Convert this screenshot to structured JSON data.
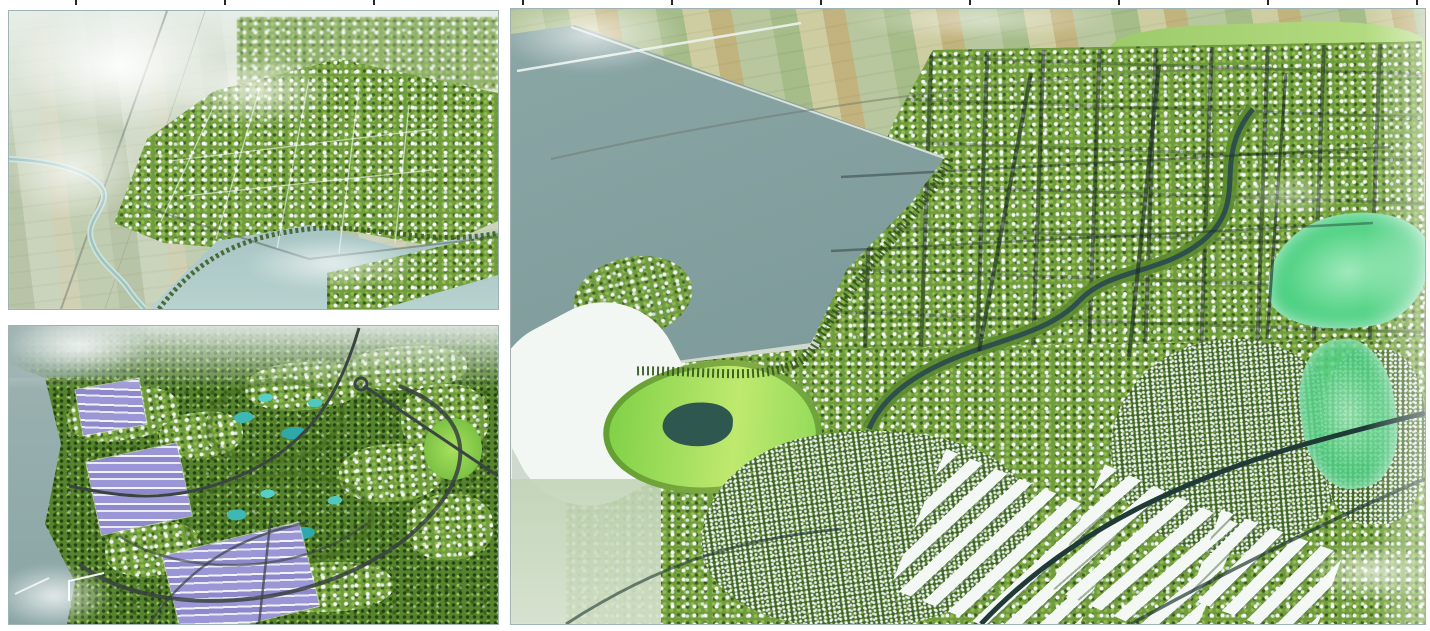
{
  "figure": {
    "alt": "Board of three aerial perspective renderings of a green waterfront urban masterplan with white buildings, tree-lined streets, parks and rivers",
    "media_type": "3D urban masterplan visualization",
    "panel_count": 3,
    "panels": [
      {
        "id": "top-left",
        "alt": "Bird's-eye view of a new town spreading along a pale teal lake; hazy farmland, a railway line and fog to the west, a winding river reaching the shore, and a built peninsula in the lower right"
      },
      {
        "id": "bottom-left",
        "alt": "Aerial view of a garden city wrapped in tree canopy with curving ring roads, two bright central parks with turquoise lakes, scattered white housing clusters, and violet solar-roofed blocks along the grey waterfront on the left"
      },
      {
        "id": "right",
        "alt": "Large aerial view of a gridded eco-city beside a wide grey-teal bay; patchwork farmland and a bridge at top, a winding tree-lined creek through the centre, a glowing green park with a pond at left, dense white low-rise housing and warehouse rows below, and emerald parks fading into haze at right"
      }
    ],
    "edge_marks": {
      "count": 10,
      "note": "small dark tick marks along the very top edge"
    },
    "palette": {
      "background": "#ffffff",
      "frame_border": "#9fb4b2",
      "water_grey_teal": "#85a1a1",
      "water_light": "#a9c7c6",
      "forest_green": "#55832e",
      "canopy_light": "#a3cc58",
      "building_white": "#f2f6f4",
      "park_bright": "#a5d145",
      "park_emerald": "#57d488",
      "lake_turquoise": "#3db8b4",
      "solar_violet": "#9b97d6",
      "farm_tan": "#caa45e",
      "road_dark": "#36423f",
      "haze": "#ffffff"
    }
  }
}
